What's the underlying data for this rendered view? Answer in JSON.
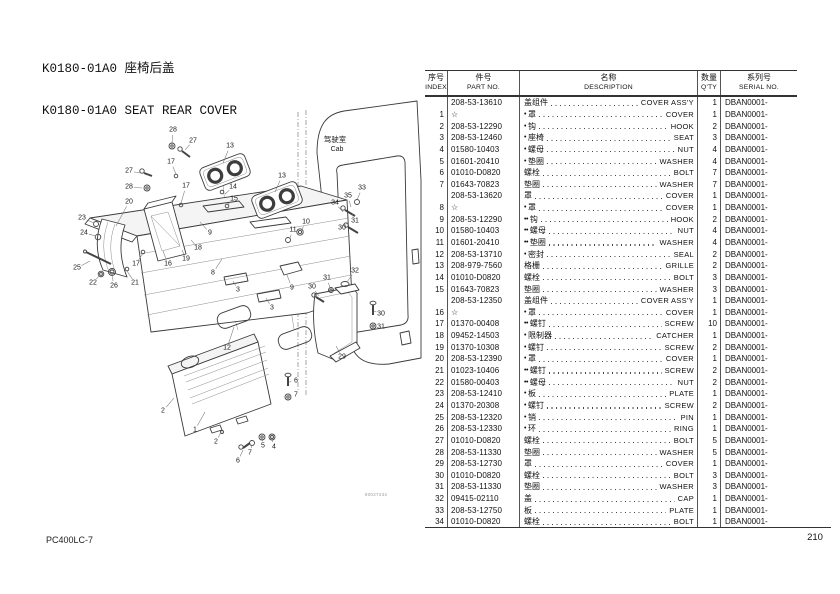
{
  "page": {
    "title_line1": "K0180-01A0 座椅后盖",
    "title_line2": "K0180-01A0 SEAT REAR COVER",
    "footer_model": "PC400LC-7",
    "footer_page": "210",
    "drawing_number": "00027434"
  },
  "diagram": {
    "cab_label_cn": "驾驶室",
    "cab_label_en": "Cab",
    "callouts": [
      {
        "label": "28",
        "x": 173,
        "y": 130,
        "tx": 172,
        "ty": 144
      },
      {
        "label": "27",
        "x": 193,
        "y": 141,
        "tx": 185,
        "ty": 150
      },
      {
        "label": "17",
        "x": 171,
        "y": 162,
        "tx": 176,
        "ty": 174
      },
      {
        "label": "13",
        "x": 230,
        "y": 146,
        "tx": 223,
        "ty": 163
      },
      {
        "label": "13",
        "x": 282,
        "y": 176,
        "tx": 275,
        "ty": 192
      },
      {
        "label": "14",
        "x": 233,
        "y": 187,
        "tx": 225,
        "ty": 194
      },
      {
        "label": "15",
        "x": 234,
        "y": 199,
        "tx": 227,
        "ty": 205
      },
      {
        "label": "27",
        "x": 129,
        "y": 171,
        "tx": 140,
        "ty": 173
      },
      {
        "label": "28",
        "x": 129,
        "y": 187,
        "tx": 142,
        "ty": 188
      },
      {
        "label": "20",
        "x": 129,
        "y": 202,
        "tx": 116,
        "ty": 226
      },
      {
        "label": "23",
        "x": 82,
        "y": 218,
        "tx": 94,
        "ty": 223
      },
      {
        "label": "24",
        "x": 84,
        "y": 233,
        "tx": 96,
        "ty": 236
      },
      {
        "label": "25",
        "x": 77,
        "y": 268,
        "tx": 90,
        "ty": 261
      },
      {
        "label": "22",
        "x": 93,
        "y": 283,
        "tx": 100,
        "ty": 275
      },
      {
        "label": "26",
        "x": 114,
        "y": 286,
        "tx": 112,
        "ty": 275
      },
      {
        "label": "21",
        "x": 135,
        "y": 283,
        "tx": 127,
        "ty": 271
      },
      {
        "label": "17",
        "x": 136,
        "y": 264,
        "tx": 143,
        "ty": 253
      },
      {
        "label": "17",
        "x": 186,
        "y": 186,
        "tx": 181,
        "ty": 203
      },
      {
        "label": "9",
        "x": 210,
        "y": 233,
        "tx": 200,
        "ty": 222
      },
      {
        "label": "18",
        "x": 198,
        "y": 248,
        "tx": 191,
        "ty": 240
      },
      {
        "label": "19",
        "x": 186,
        "y": 259,
        "tx": 182,
        "ty": 250
      },
      {
        "label": "16",
        "x": 168,
        "y": 264,
        "tx": 163,
        "ty": 251
      },
      {
        "label": "8",
        "x": 213,
        "y": 273,
        "tx": 222,
        "ty": 259
      },
      {
        "label": "3",
        "x": 238,
        "y": 290,
        "tx": 233,
        "ty": 281
      },
      {
        "label": "3",
        "x": 272,
        "y": 308,
        "tx": 266,
        "ty": 298
      },
      {
        "label": "9",
        "x": 292,
        "y": 288,
        "tx": 287,
        "ty": 275
      },
      {
        "label": "30",
        "x": 312,
        "y": 287,
        "tx": 319,
        "ty": 296
      },
      {
        "label": "31",
        "x": 327,
        "y": 278,
        "tx": 330,
        "ty": 288
      },
      {
        "label": "32",
        "x": 355,
        "y": 271,
        "tx": 347,
        "ty": 282
      },
      {
        "label": "30",
        "x": 381,
        "y": 314,
        "tx": 374,
        "ty": 311
      },
      {
        "label": "31",
        "x": 381,
        "y": 327,
        "tx": 374,
        "ty": 325
      },
      {
        "label": "29",
        "x": 342,
        "y": 357,
        "tx": 336,
        "ty": 346
      },
      {
        "label": "12",
        "x": 227,
        "y": 348,
        "tx": 234,
        "ty": 327
      },
      {
        "label": "10",
        "x": 306,
        "y": 222,
        "tx": 301,
        "ty": 231
      },
      {
        "label": "11",
        "x": 293,
        "y": 230,
        "tx": 290,
        "ty": 238
      },
      {
        "label": "33",
        "x": 362,
        "y": 188,
        "tx": 357,
        "ty": 200
      },
      {
        "label": "35",
        "x": 348,
        "y": 196,
        "tx": 351,
        "ty": 207
      },
      {
        "label": "34",
        "x": 335,
        "y": 203,
        "tx": 343,
        "ty": 212
      },
      {
        "label": "31",
        "x": 355,
        "y": 221,
        "tx": 352,
        "ty": 214
      },
      {
        "label": "30",
        "x": 342,
        "y": 228,
        "tx": 347,
        "ty": 223
      },
      {
        "label": "2",
        "x": 163,
        "y": 411,
        "tx": 174,
        "ty": 398
      },
      {
        "label": "1",
        "x": 195,
        "y": 430,
        "tx": 205,
        "ty": 412
      },
      {
        "label": "2",
        "x": 216,
        "y": 442,
        "tx": 221,
        "ty": 432
      },
      {
        "label": "6",
        "x": 238,
        "y": 461,
        "tx": 243,
        "ty": 450
      },
      {
        "label": "7",
        "x": 250,
        "y": 453,
        "tx": 252,
        "ty": 445
      },
      {
        "label": "5",
        "x": 263,
        "y": 446,
        "tx": 262,
        "ty": 439
      },
      {
        "label": "4",
        "x": 274,
        "y": 447,
        "tx": 272,
        "ty": 440
      },
      {
        "label": "6",
        "x": 296,
        "y": 381,
        "tx": 289,
        "ty": 382
      },
      {
        "label": "7",
        "x": 296,
        "y": 395,
        "tx": 289,
        "ty": 396
      }
    ]
  },
  "table": {
    "headers": {
      "index_cn": "序号",
      "index_en": "INDEX",
      "part_cn": "件号",
      "part_en": "PART NO.",
      "desc_cn": "名称",
      "desc_en": "DESCRIPTION",
      "qty_cn": "数量",
      "qty_en": "Q'TY",
      "serial_cn": "系列号",
      "serial_en": "SERIAL NO."
    },
    "rows": [
      {
        "index": "",
        "part": "208-53-13610",
        "b": 0,
        "cn": "盖组件",
        "en": "COVER ASS'Y",
        "qty": "1",
        "serial": "DBAN0001-"
      },
      {
        "index": "1",
        "part": "☆",
        "b": 1,
        "cn": "罩",
        "en": "COVER",
        "qty": "1",
        "serial": "DBAN0001-"
      },
      {
        "index": "2",
        "part": "208-53-12290",
        "b": 1,
        "cn": "钩",
        "en": "HOOK",
        "qty": "2",
        "serial": "DBAN0001-"
      },
      {
        "index": "3",
        "part": "208-53-12460",
        "b": 1,
        "cn": "座椅",
        "en": "SEAT",
        "qty": "3",
        "serial": "DBAN0001-"
      },
      {
        "index": "4",
        "part": "01580-10403",
        "b": 1,
        "cn": "螺母",
        "en": "NUT",
        "qty": "4",
        "serial": "DBAN0001-"
      },
      {
        "index": "5",
        "part": "01601-20410",
        "b": 1,
        "cn": "垫圈",
        "en": "WASHER",
        "qty": "4",
        "serial": "DBAN0001-"
      },
      {
        "index": "6",
        "part": "01010-D0820",
        "b": 0,
        "cn": "螺栓",
        "en": "BOLT",
        "qty": "7",
        "serial": "DBAN0001-"
      },
      {
        "index": "7",
        "part": "01643-70823",
        "b": 0,
        "cn": "垫圈",
        "en": "WASHER",
        "qty": "7",
        "serial": "DBAN0001-"
      },
      {
        "index": "",
        "part": "208-53-13620",
        "b": 0,
        "cn": "罩",
        "en": "COVER",
        "qty": "1",
        "serial": "DBAN0001-"
      },
      {
        "index": "8",
        "part": "☆",
        "b": 1,
        "cn": "罩",
        "en": "COVER",
        "qty": "1",
        "serial": "DBAN0001-"
      },
      {
        "index": "9",
        "part": "208-53-12290",
        "b": 2,
        "cn": "钩",
        "en": "HOOK",
        "qty": "2",
        "serial": "DBAN0001-"
      },
      {
        "index": "10",
        "part": "01580-10403",
        "b": 2,
        "cn": "螺母",
        "en": "NUT",
        "qty": "4",
        "serial": "DBAN0001-"
      },
      {
        "index": "11",
        "part": "01601-20410",
        "b": 2,
        "cn": "垫圈",
        "en": "WASHER",
        "qty": "4",
        "serial": "DBAN0001-"
      },
      {
        "index": "12",
        "part": "208-53-13710",
        "b": 1,
        "cn": "密封",
        "en": "SEAL",
        "qty": "2",
        "serial": "DBAN0001-"
      },
      {
        "index": "13",
        "part": "208-979-7560",
        "b": 0,
        "cn": "格栅",
        "en": "GRILLE",
        "qty": "2",
        "serial": "DBAN0001-"
      },
      {
        "index": "14",
        "part": "01010-D0820",
        "b": 0,
        "cn": "螺栓",
        "en": "BOLT",
        "qty": "3",
        "serial": "DBAN0001-"
      },
      {
        "index": "15",
        "part": "01643-70823",
        "b": 0,
        "cn": "垫圈",
        "en": "WASHER",
        "qty": "3",
        "serial": "DBAN0001-"
      },
      {
        "index": "",
        "part": "208-53-12350",
        "b": 0,
        "cn": "盖组件",
        "en": "COVER ASS'Y",
        "qty": "1",
        "serial": "DBAN0001-"
      },
      {
        "index": "16",
        "part": "☆",
        "b": 1,
        "cn": "罩",
        "en": "COVER",
        "qty": "1",
        "serial": "DBAN0001-"
      },
      {
        "index": "17",
        "part": "01370-00408",
        "b": 2,
        "cn": "螺钉",
        "en": "SCREW",
        "qty": "10",
        "serial": "DBAN0001-"
      },
      {
        "index": "18",
        "part": "09452-14503",
        "b": 1,
        "cn": "限制器",
        "en": "CATCHER",
        "qty": "1",
        "serial": "DBAN0001-"
      },
      {
        "index": "19",
        "part": "01370-10308",
        "b": 1,
        "cn": "螺钉",
        "en": "SCREW",
        "qty": "2",
        "serial": "DBAN0001-"
      },
      {
        "index": "20",
        "part": "208-53-12390",
        "b": 1,
        "cn": "罩",
        "en": "COVER",
        "qty": "1",
        "serial": "DBAN0001-"
      },
      {
        "index": "21",
        "part": "01023-10406",
        "b": 2,
        "cn": "螺钉",
        "en": "SCREW",
        "qty": "2",
        "serial": "DBAN0001-"
      },
      {
        "index": "22",
        "part": "01580-00403",
        "b": 2,
        "cn": "螺母",
        "en": "NUT",
        "qty": "2",
        "serial": "DBAN0001-"
      },
      {
        "index": "23",
        "part": "208-53-12410",
        "b": 1,
        "cn": "板",
        "en": "PLATE",
        "qty": "1",
        "serial": "DBAN0001-"
      },
      {
        "index": "24",
        "part": "01370-20308",
        "b": 1,
        "cn": "螺钉",
        "en": "SCREW",
        "qty": "2",
        "serial": "DBAN0001-"
      },
      {
        "index": "25",
        "part": "208-53-12320",
        "b": 1,
        "cn": "销",
        "en": "PIN",
        "qty": "1",
        "serial": "DBAN0001-"
      },
      {
        "index": "26",
        "part": "208-53-12330",
        "b": 1,
        "cn": "环",
        "en": "RING",
        "qty": "1",
        "serial": "DBAN0001-"
      },
      {
        "index": "27",
        "part": "01010-D0820",
        "b": 0,
        "cn": "螺栓",
        "en": "BOLT",
        "qty": "5",
        "serial": "DBAN0001-"
      },
      {
        "index": "28",
        "part": "208-53-11330",
        "b": 0,
        "cn": "垫圈",
        "en": "WASHER",
        "qty": "5",
        "serial": "DBAN0001-"
      },
      {
        "index": "29",
        "part": "208-53-12730",
        "b": 0,
        "cn": "罩",
        "en": "COVER",
        "qty": "1",
        "serial": "DBAN0001-"
      },
      {
        "index": "30",
        "part": "01010-D0820",
        "b": 0,
        "cn": "螺栓",
        "en": "BOLT",
        "qty": "3",
        "serial": "DBAN0001-"
      },
      {
        "index": "31",
        "part": "208-53-11330",
        "b": 0,
        "cn": "垫圈",
        "en": "WASHER",
        "qty": "3",
        "serial": "DBAN0001-"
      },
      {
        "index": "32",
        "part": "09415-02110",
        "b": 0,
        "cn": "盖",
        "en": "CAP",
        "qty": "1",
        "serial": "DBAN0001-"
      },
      {
        "index": "33",
        "part": "208-53-12750",
        "b": 0,
        "cn": "板",
        "en": "PLATE",
        "qty": "1",
        "serial": "DBAN0001-"
      },
      {
        "index": "34",
        "part": "01010-D0820",
        "b": 0,
        "cn": "螺栓",
        "en": "BOLT",
        "qty": "1",
        "serial": "DBAN0001-"
      }
    ]
  }
}
